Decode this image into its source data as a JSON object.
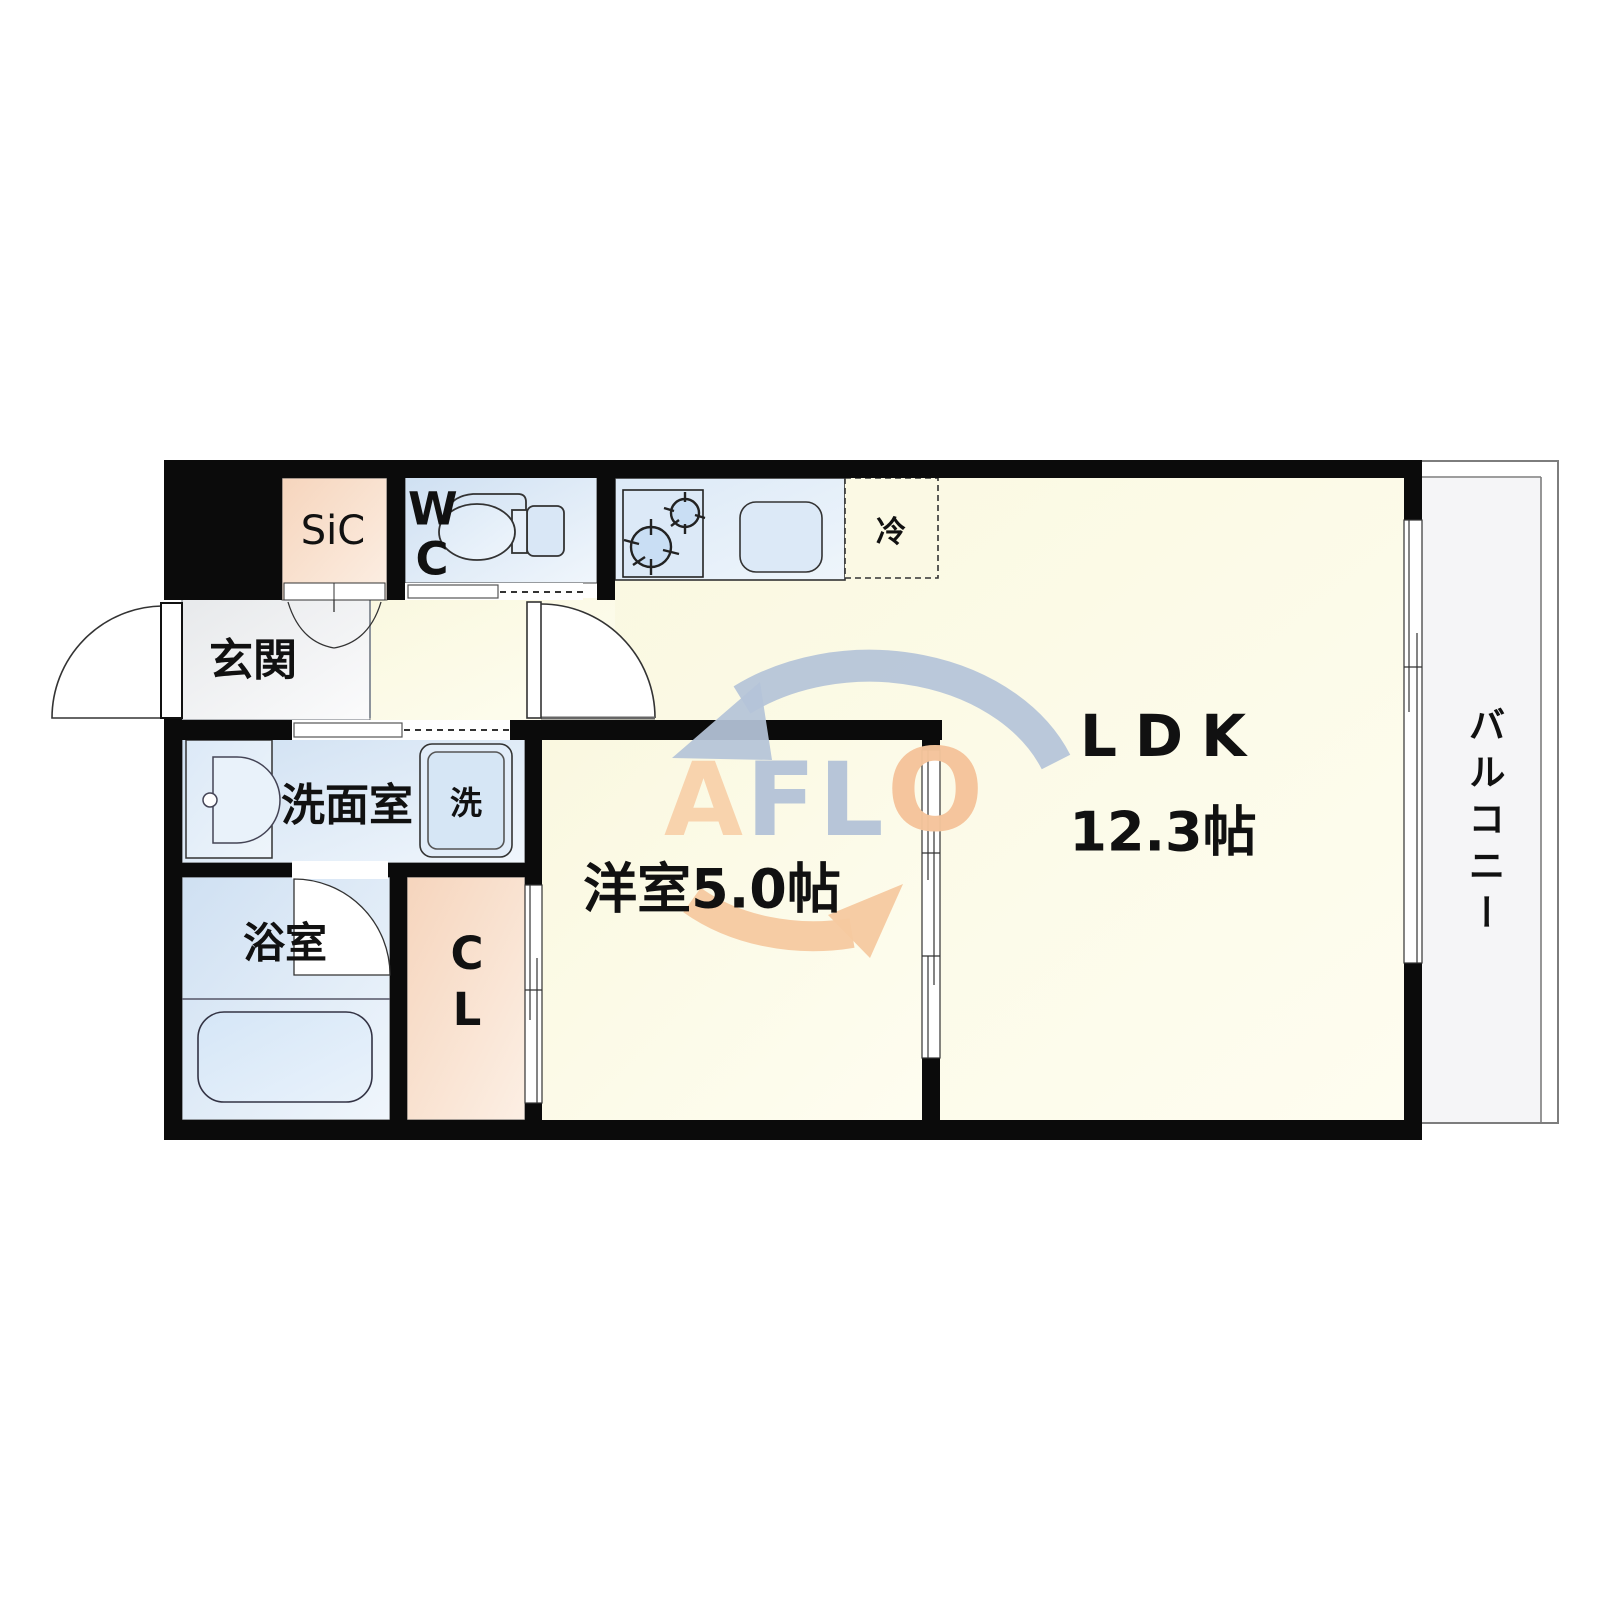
{
  "plan": {
    "title": "1LDK floor plan",
    "rooms": {
      "entrance": {
        "label": "玄関"
      },
      "shoe_closet": {
        "label": "SiC"
      },
      "wc": {
        "label": "WC"
      },
      "washroom": {
        "label": "洗面室"
      },
      "washing_machine су": {
        "label": ""
      },
      "washer": {
        "label": "洗"
      },
      "bathroom": {
        "label": "浴室"
      },
      "closet": {
        "label": "CL"
      },
      "western_room": {
        "label": "洋室5.0帖"
      },
      "ldk": {
        "label": "LDK",
        "size": "12.3帖"
      },
      "refrigerator": {
        "label": "冷"
      },
      "balcony": {
        "label": "バルコニー"
      }
    },
    "watermark": {
      "name": "AFLO",
      "letters": [
        {
          "char": "A",
          "color": "#f8d2ac"
        },
        {
          "char": "F",
          "color": "#b5c4d8"
        },
        {
          "char": "L",
          "color": "#b5c4d8"
        },
        {
          "char": "O",
          "color": "#f5c49b"
        }
      ],
      "arrow_top_color": "#b5c4d8",
      "arrow_bottom_color": "#f6c9a0"
    },
    "colors": {
      "wall": "#0b0b0b",
      "floor_yellow": "#faf8e1",
      "room_blue": "#d2e2f3",
      "room_peach": "#f6d7c0",
      "entrance_gray": "#e9ebed",
      "balcony_gray": "#f5f5f7"
    }
  }
}
